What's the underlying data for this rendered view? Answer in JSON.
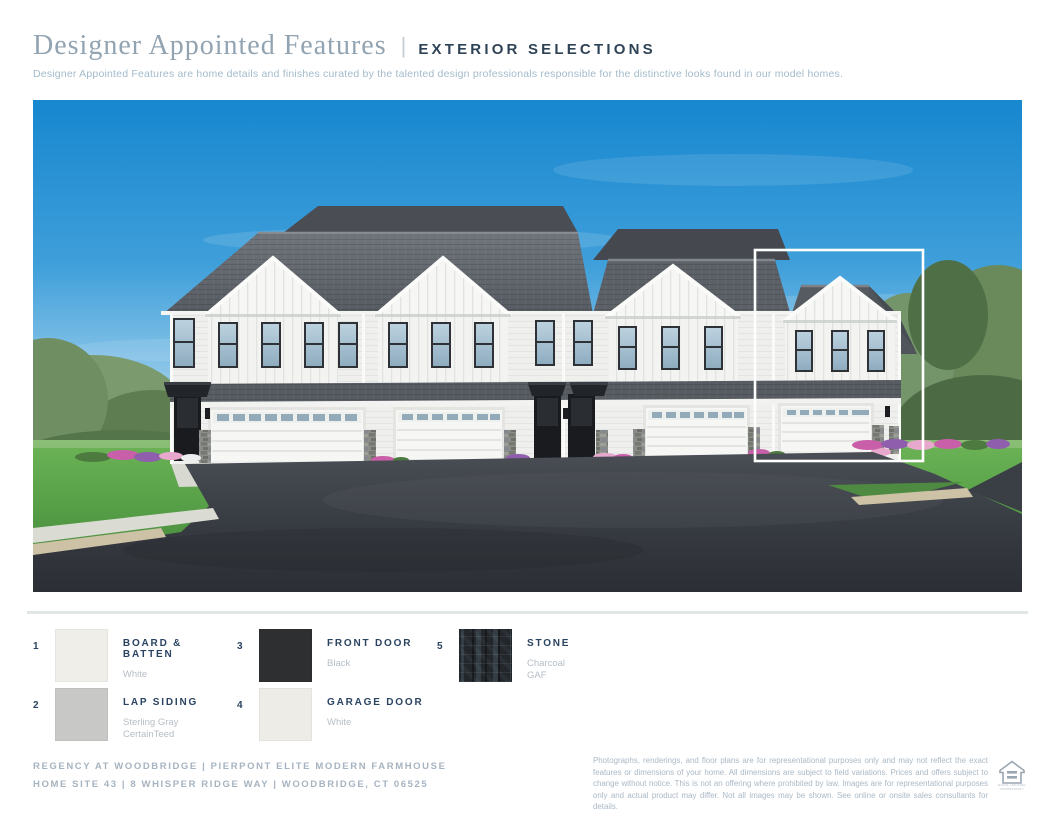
{
  "header": {
    "title": "Designer Appointed Features",
    "separator": "|",
    "tag": "EXTERIOR SELECTIONS",
    "subtitle": "Designer Appointed Features are home details and finishes curated by the talented design professionals responsible for the distinctive looks found in our model homes."
  },
  "selections": [
    {
      "number": "1",
      "label": "BOARD & BATTEN",
      "finish": "White",
      "brand": "",
      "swatch_color": "#efeee9"
    },
    {
      "number": "3",
      "label": "FRONT DOOR",
      "finish": "Black",
      "brand": "",
      "swatch_color": "#2d2f30"
    },
    {
      "number": "5",
      "label": "STONE",
      "finish": "Charcoal",
      "brand": "GAF",
      "swatch_color": "#23272c"
    },
    {
      "number": "2",
      "label": "LAP SIDING",
      "finish": "Sterling Gray",
      "brand": "CertainTeed",
      "swatch_color": "#c8c8c6"
    },
    {
      "number": "4",
      "label": "GARAGE DOOR",
      "finish": "White",
      "brand": "",
      "swatch_color": "#edece6"
    }
  ],
  "footer": {
    "community_line": "REGENCY AT WOODBRIDGE  |  PIERPONT ELITE MODERN FARMHOUSE",
    "site_line": "HOME SITE 43  |  8 WHISPER RIDGE WAY  |  WOODBRIDGE, CT 06525",
    "disclaimer": "Photographs, renderings, and floor plans are for representational purposes only and may not reflect the exact features or dimensions of your home. All dimensions are subject to field variations. Prices and offers subject to change without notice. This is not an offering where prohibited by law. Images are for representational purposes only and actual product may differ. Not all images may be shown. See online or onsite sales consultants for details.",
    "equal_housing_label": "EQUAL HOUSING OPPORTUNITY"
  },
  "colors": {
    "title_serif": "#92a3b1",
    "heading_navy": "#2f4356",
    "muted_bluegray": "#aab9c6",
    "sky_blue": "#1787cf",
    "roof_gray": "#565b62",
    "lawn_green": "#58a148",
    "asphalt": "#33363c"
  }
}
